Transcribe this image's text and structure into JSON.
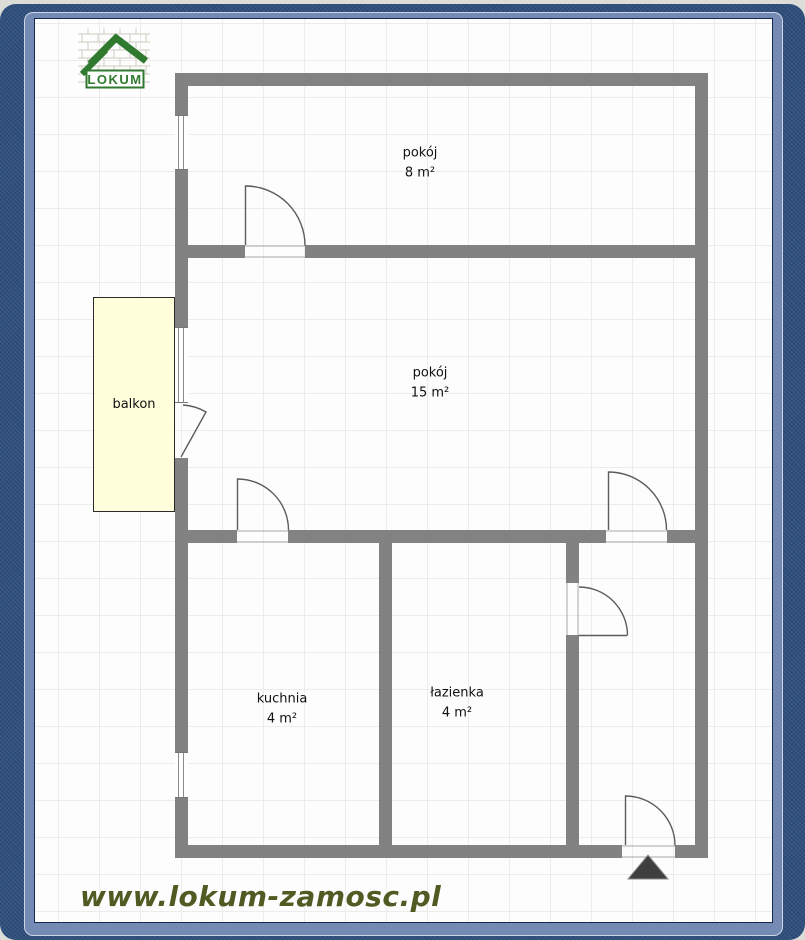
{
  "branding": {
    "logo_text": "LOKUM",
    "website": "www.lokum-zamosc.pl"
  },
  "rooms": [
    {
      "name": "pokój",
      "area": "8 m²"
    },
    {
      "name": "pokój",
      "area": "15 m²"
    },
    {
      "name": "kuchnia",
      "area": "4 m²"
    },
    {
      "name": "łazienka",
      "area": "4 m²"
    },
    {
      "name": "balkon",
      "area": ""
    }
  ],
  "colors": {
    "wall": "#828282",
    "frame_dark_blue": "#2e4e7c",
    "frame_light_blue": "#7188b3",
    "sheet_grid": "#ececec",
    "balcony_fill": "#ffffdb",
    "logo_green": "#2f7a2f",
    "website_text": "#4f5b22",
    "entrance_marker": "#3f3f3f"
  }
}
